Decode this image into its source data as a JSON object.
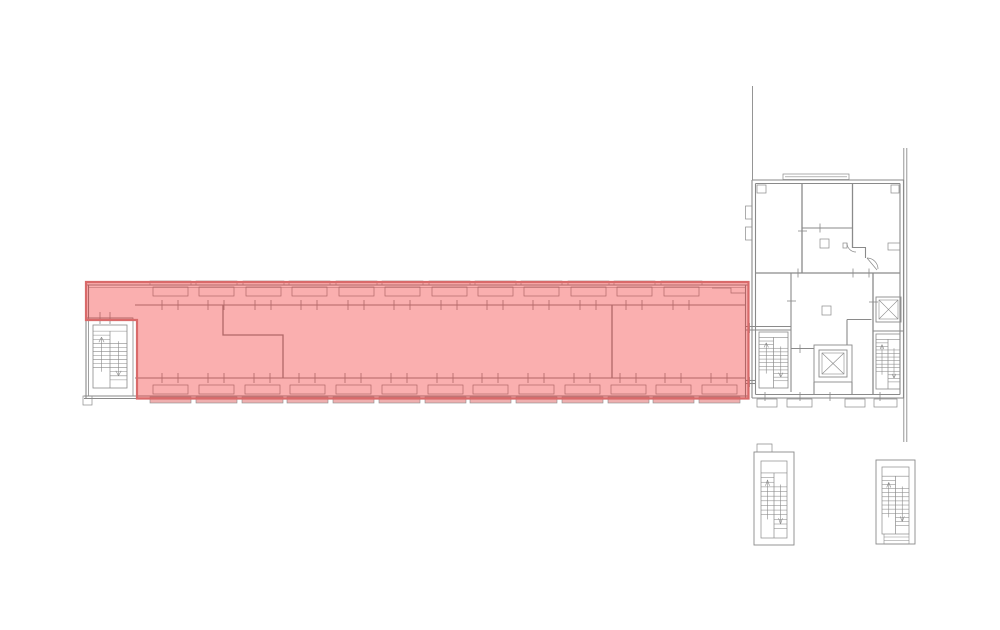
{
  "document": {
    "kind": "architectural floor plan",
    "visible_text": ""
  },
  "colors": {
    "background": "#ffffff",
    "line": "#8a8a8a",
    "line_dark": "#7c7c7c",
    "highlight_fill": "rgba(242,45,45,0.38)",
    "highlight_border": "#d96a6a",
    "sill_fill": "rgba(225,110,110,0.55)"
  },
  "elements": {
    "highlighted_wing": "highlighted-wing",
    "west_stairwell": "west-stairwell",
    "east_building": "east-building",
    "elevator_shaft_central": "elevator-shaft-central",
    "elevator_shaft_east": "elevator-shaft-east",
    "east_building_stairwell_left": "east-building-stairwell-left",
    "east_building_stairwell_right": "east-building-stairwell-right",
    "detached_stairwell_left": "detached-stairwell-left",
    "detached_stairwell_right": "detached-stairwell-right"
  }
}
